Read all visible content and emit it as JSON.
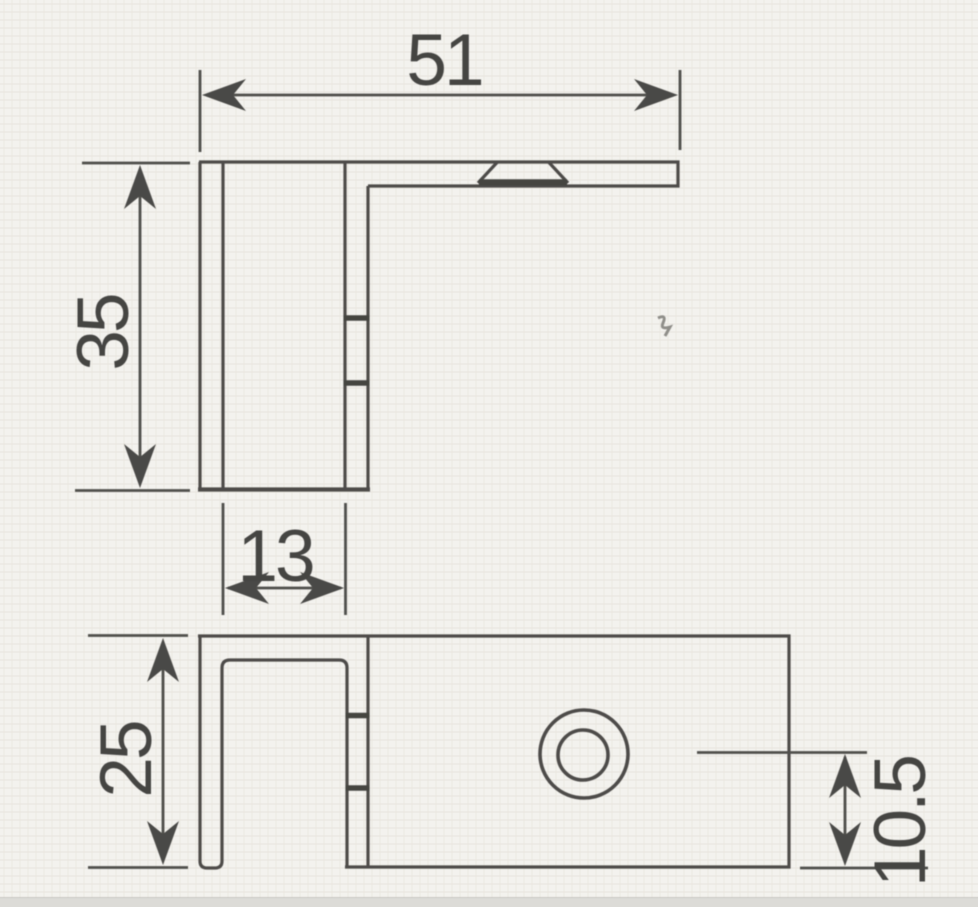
{
  "dimensions": {
    "arm_length": "51",
    "overall_height": "35",
    "slot_width": "13",
    "front_height": "25",
    "hole_offset": "10.5"
  },
  "colors": {
    "paper": "#f2f1ed",
    "ink": "#4d4c49",
    "text": "#454442",
    "scan_edge_strip": "#dcdbd7"
  }
}
